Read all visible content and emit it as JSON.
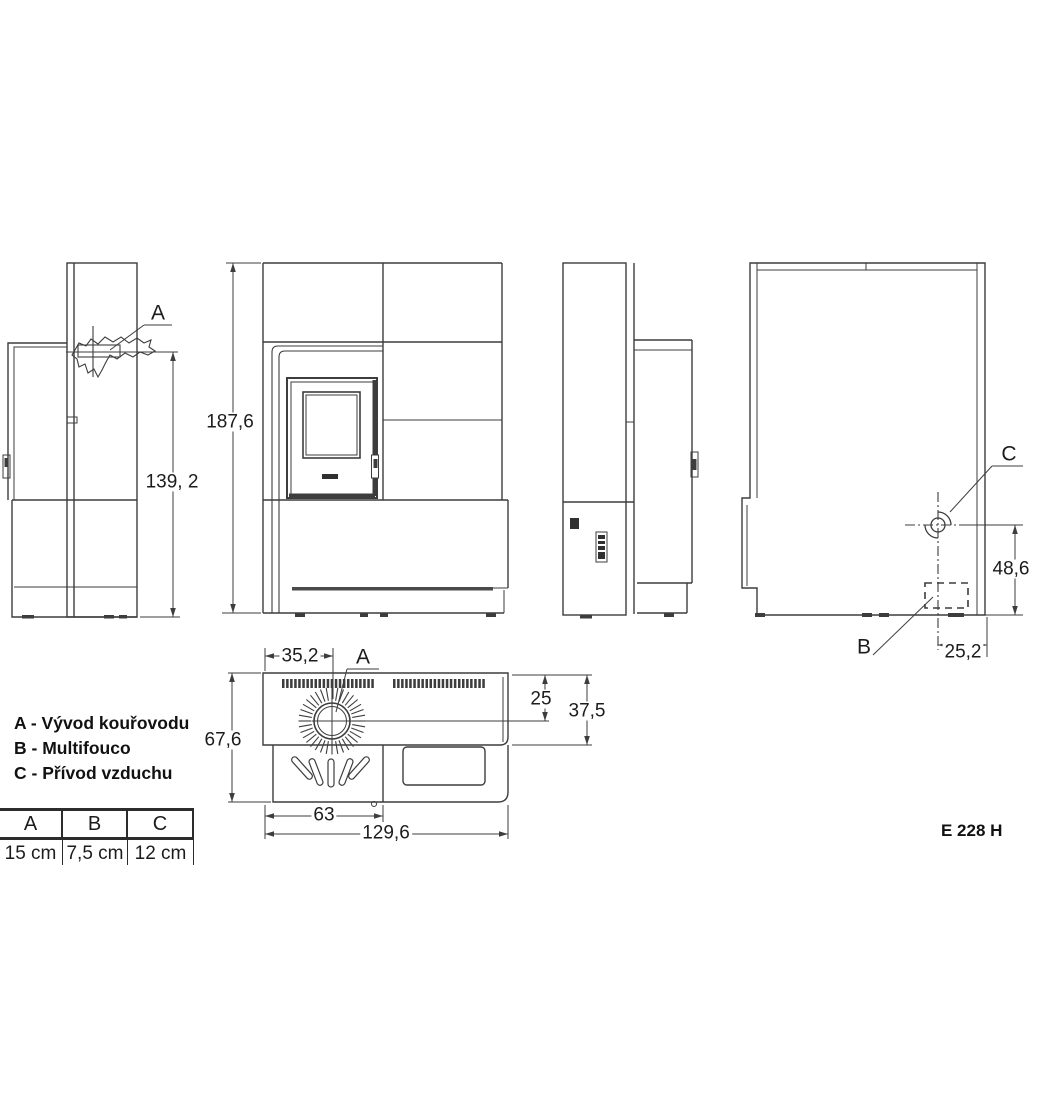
{
  "model_label": "E 228 H",
  "legend": {
    "items": [
      "A - Vývod kouřovodu",
      "B - Multifouco",
      "C - Přívod vzduchu"
    ]
  },
  "spec_table": {
    "headers": [
      "A",
      "B",
      "C"
    ],
    "values": [
      "15 cm",
      "7,5 cm",
      "12 cm"
    ]
  },
  "labels": {
    "side_view": {
      "a": "A",
      "height_to_flue": "139, 2"
    },
    "front_view": {
      "total_height": "187,6"
    },
    "rear_view": {
      "c": "C",
      "b": "B",
      "inlet_height": "48,6",
      "inlet_offset": "25,2"
    },
    "top_view": {
      "a": "A",
      "flue_x": "35,2",
      "flue_y": "25",
      "top_depth": "37,5",
      "depth": "67,6",
      "front_width": "63",
      "total_width": "129,6"
    }
  },
  "colors": {
    "line": "#3d3d3d",
    "text": "#1c1c1c",
    "background": "#ffffff"
  }
}
